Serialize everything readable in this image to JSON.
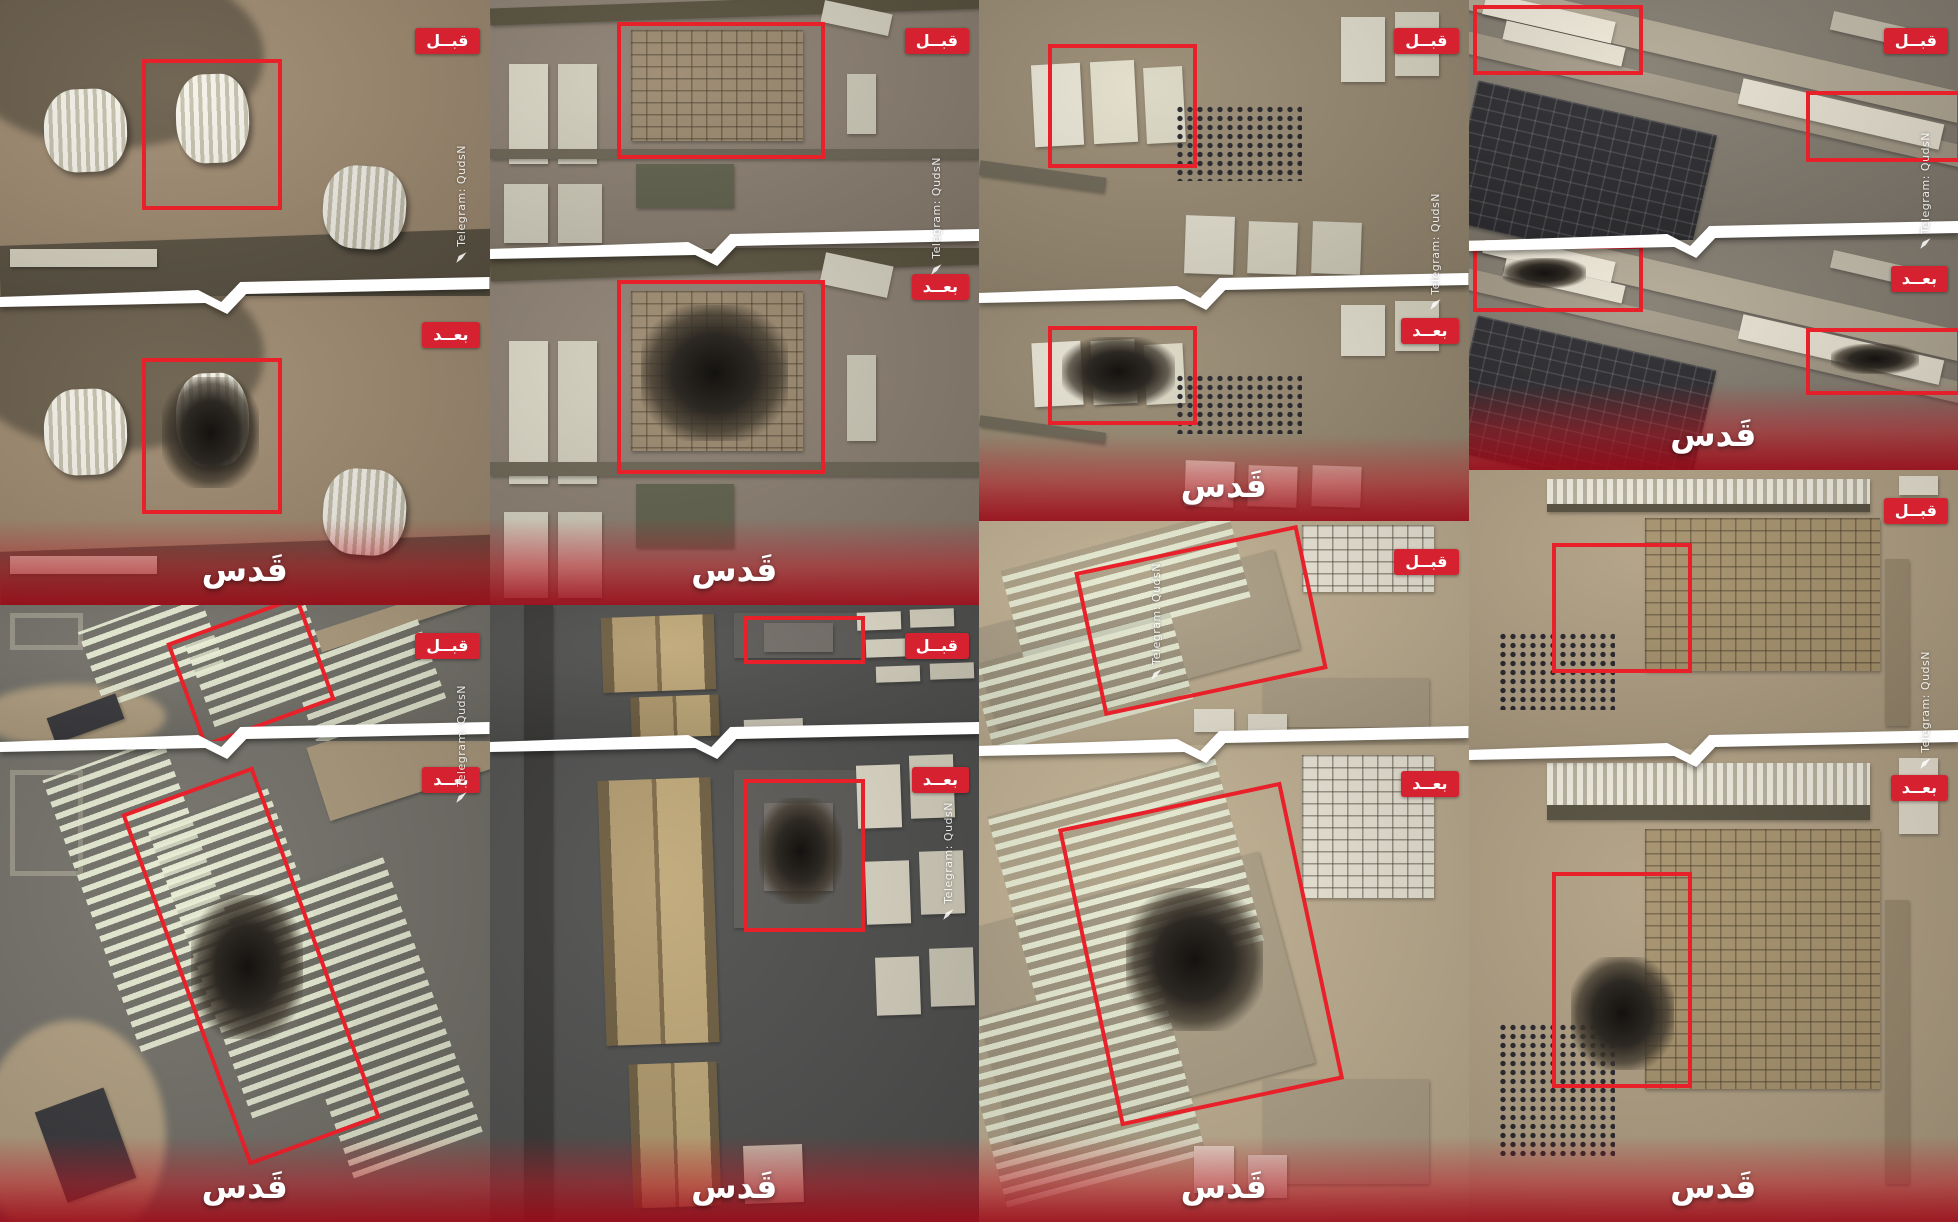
{
  "labels": {
    "before": "قبــل",
    "after": "بعــد",
    "quds_watermark": "قَدس",
    "telegram": "Telegram: QudsN"
  },
  "colors": {
    "badge_red": "#d62230",
    "target_box_red": "#e8202a",
    "separator_white": "#ffffff",
    "after_fade_red": "#b41824",
    "watermark_white": "#ffffff"
  },
  "grid": {
    "columns": 4,
    "rows": 2,
    "width_px": 1958,
    "height_px": 1222
  },
  "pairs": [
    {
      "name": "hangars-site",
      "col": 0,
      "top": 0,
      "height": 49.5,
      "split": 49,
      "scene": {
        "base": "#a08c72",
        "shapes": [
          {
            "x": -10,
            "y": -20,
            "w": 40,
            "h": 45,
            "c": "#44474a",
            "k": "blob"
          },
          {
            "x": -8,
            "y": -12,
            "w": 62,
            "h": 62,
            "c": "#6b5f4c",
            "k": "blob"
          },
          {
            "x": 0,
            "y": 80,
            "w": 104,
            "h": 24,
            "c": "#5d5545",
            "r": -2
          },
          {
            "x": 2,
            "y": 84,
            "w": 30,
            "h": 6,
            "c": "#ddd8c6"
          },
          {
            "x": 9,
            "y": 30,
            "w": 17,
            "h": 28,
            "k": "hangar",
            "r": -2
          },
          {
            "x": 36,
            "y": 25,
            "w": 15,
            "h": 30,
            "k": "hangar",
            "r": -2
          },
          {
            "x": 66,
            "y": 56,
            "w": 17,
            "h": 28,
            "k": "hangar",
            "r": 4
          }
        ]
      },
      "boxes": [
        {
          "x": 29,
          "y": 20,
          "w": 27,
          "h": 48
        }
      ],
      "damage": [
        {
          "x": 33,
          "y": 26,
          "w": 20,
          "h": 36
        }
      ],
      "telegram": {
        "x": 93,
        "y": 24
      }
    },
    {
      "name": "barracks-compound",
      "col": 1,
      "top": 0,
      "height": 49.5,
      "split": 41,
      "scene": {
        "base": "#8d8173",
        "shapes": [
          {
            "x": 0,
            "y": 0,
            "w": 100,
            "h": 7,
            "c": "#59523f",
            "r": -2
          },
          {
            "x": 4,
            "y": 26,
            "w": 8,
            "h": 40,
            "c": "#dcd8c7"
          },
          {
            "x": 14,
            "y": 26,
            "w": 8,
            "h": 40,
            "c": "#d4d0bf"
          },
          {
            "x": 3,
            "y": 74,
            "w": 9,
            "h": 24,
            "c": "#d9d5c4"
          },
          {
            "x": 14,
            "y": 74,
            "w": 9,
            "h": 24,
            "c": "#d1cdbc"
          },
          {
            "x": 29,
            "y": 12,
            "w": 35,
            "h": 45,
            "c": "#9c8a70",
            "k": "blocks"
          },
          {
            "x": 68,
            "y": 3,
            "w": 14,
            "h": 9,
            "c": "#d6d2c2",
            "r": 12
          },
          {
            "x": 73,
            "y": 30,
            "w": 6,
            "h": 24,
            "c": "#cfcbba"
          },
          {
            "x": 30,
            "y": 66,
            "w": 20,
            "h": 18,
            "c": "#63634f"
          },
          {
            "x": 0,
            "y": 60,
            "w": 100,
            "h": 4,
            "c": "#6e6757"
          }
        ]
      },
      "boxes": [
        {
          "x": 26,
          "y": 9,
          "w": 41,
          "h": 52
        }
      ],
      "damage": [
        {
          "x": 31,
          "y": 16,
          "w": 30,
          "h": 38
        }
      ],
      "telegram": {
        "x": 90,
        "y": 26
      }
    },
    {
      "name": "warehouse-tanks-site",
      "col": 2,
      "top": 0,
      "height": 42.6,
      "split": 56,
      "scene": {
        "base": "#998b73",
        "shapes": [
          {
            "x": 11,
            "y": 22,
            "w": 10,
            "h": 28,
            "c": "#e8e4d4",
            "r": -3
          },
          {
            "x": 23,
            "y": 21,
            "w": 9,
            "h": 28,
            "c": "#e2deca",
            "r": -3
          },
          {
            "x": 34,
            "y": 23,
            "w": 8,
            "h": 26,
            "c": "#dbd7c4",
            "r": -3
          },
          {
            "x": 40,
            "y": 36,
            "w": 26,
            "h": 26,
            "k": "dots"
          },
          {
            "x": 74,
            "y": 6,
            "w": 9,
            "h": 22,
            "c": "#e4e0d0"
          },
          {
            "x": 85,
            "y": 4,
            "w": 9,
            "h": 22,
            "c": "#ddd9c6"
          },
          {
            "x": 42,
            "y": 74,
            "w": 10,
            "h": 20,
            "c": "#e6e2d2",
            "r": 2
          },
          {
            "x": 55,
            "y": 76,
            "w": 10,
            "h": 18,
            "c": "#dfdbc9",
            "r": 2
          },
          {
            "x": 68,
            "y": 76,
            "w": 10,
            "h": 18,
            "c": "#d8d4c2",
            "r": 2
          },
          {
            "x": 0,
            "y": 58,
            "w": 26,
            "h": 5,
            "c": "#6e6757",
            "r": 8
          }
        ]
      },
      "boxes": [
        {
          "x": 14,
          "y": 15,
          "w": 29,
          "h": 40
        }
      ],
      "damage": [
        {
          "x": 17,
          "y": 20,
          "w": 23,
          "h": 30
        }
      ],
      "telegram": {
        "x": 92,
        "y": 37
      }
    },
    {
      "name": "airbase-complex",
      "col": 3,
      "top": 0,
      "height": 38.5,
      "split": 51,
      "scene": {
        "base": "#847d71",
        "shapes": [
          {
            "x": -5,
            "y": 16,
            "w": 115,
            "h": 13,
            "c": "#b3a995",
            "r": 13
          },
          {
            "x": -5,
            "y": 38,
            "w": 115,
            "h": 9,
            "c": "#a49a88",
            "r": 13
          },
          {
            "x": -2,
            "y": 44,
            "w": 50,
            "h": 60,
            "k": "blocks-dark",
            "r": 13
          },
          {
            "x": 3,
            "y": 3,
            "w": 27,
            "h": 9,
            "c": "#efe9d9",
            "r": 13
          },
          {
            "x": 7,
            "y": 14,
            "w": 25,
            "h": 8,
            "c": "#e6e0d0",
            "r": 13
          },
          {
            "x": 55,
            "y": 42,
            "w": 42,
            "h": 11,
            "c": "#e9e3d3",
            "r": 13
          },
          {
            "x": 74,
            "y": 8,
            "w": 15,
            "h": 8,
            "c": "#c6bfae",
            "r": 13
          }
        ]
      },
      "boxes": [
        {
          "x": 1,
          "y": 2,
          "w": 33,
          "h": 26
        },
        {
          "x": 69,
          "y": 38,
          "w": 30,
          "h": 26
        }
      ],
      "damage": [
        {
          "x": 7,
          "y": 8,
          "w": 17,
          "h": 13
        },
        {
          "x": 74,
          "y": 45,
          "w": 18,
          "h": 13
        }
      ],
      "telegram": {
        "x": 92,
        "y": 28
      }
    },
    {
      "name": "camp-rows",
      "col": 0,
      "top": 49.5,
      "height": 50.5,
      "split": 22,
      "scene": {
        "base": "#74726a",
        "shapes": [
          {
            "x": -4,
            "y": 58,
            "w": 38,
            "h": 48,
            "c": "#b3a183",
            "k": "blob"
          },
          {
            "x": 64,
            "y": -6,
            "w": 45,
            "h": 16,
            "c": "#ab9a7d",
            "r": -18
          },
          {
            "x": 2,
            "y": 6,
            "w": 13,
            "h": 20,
            "k": "ring"
          },
          {
            "x": 18,
            "y": 2,
            "w": 26,
            "h": 60,
            "k": "rows",
            "r": -20
          },
          {
            "x": 40,
            "y": 12,
            "w": 26,
            "h": 64,
            "k": "rows",
            "r": -20
          },
          {
            "x": 61,
            "y": 26,
            "w": 28,
            "h": 62,
            "k": "rows",
            "r": -20
          },
          {
            "x": 10,
            "y": 74,
            "w": 15,
            "h": 20,
            "c": "#3a3a3e",
            "r": -20
          }
        ]
      },
      "boxes": [
        {
          "x": 37,
          "y": 8,
          "w": 27,
          "h": 76,
          "r": -20
        }
      ],
      "damage": [
        {
          "x": 39,
          "y": 32,
          "w": 23,
          "h": 30
        }
      ],
      "telegram": {
        "x": 93,
        "y": 13
      }
    },
    {
      "name": "warehouse-compound",
      "col": 1,
      "top": 49.5,
      "height": 50.5,
      "split": 22,
      "scene": {
        "base": "#515150",
        "shapes": [
          {
            "x": 7,
            "y": 0,
            "w": 6,
            "h": 100,
            "c": "#3b3a38"
          },
          {
            "x": 50,
            "y": 6,
            "w": 26,
            "h": 33,
            "c": "#5d5c59"
          },
          {
            "x": 23,
            "y": 8,
            "w": 23,
            "h": 55,
            "k": "gable",
            "r": -2
          },
          {
            "x": 29,
            "y": 67,
            "w": 18,
            "h": 30,
            "k": "gable",
            "r": -2
          },
          {
            "x": 56,
            "y": 13,
            "w": 13,
            "h": 17,
            "c": "#76706a",
            "k": "ring2"
          },
          {
            "x": 75,
            "y": 5,
            "w": 9,
            "h": 13,
            "c": "#e4dfcd",
            "r": -2
          },
          {
            "x": 86,
            "y": 3,
            "w": 9,
            "h": 13,
            "c": "#dcd7c4",
            "r": -2
          },
          {
            "x": 77,
            "y": 25,
            "w": 9,
            "h": 13,
            "c": "#dfdac8",
            "r": -2
          },
          {
            "x": 88,
            "y": 23,
            "w": 9,
            "h": 13,
            "c": "#d7d2c0",
            "r": -2
          },
          {
            "x": 79,
            "y": 45,
            "w": 9,
            "h": 12,
            "c": "#dad5c3",
            "r": -2
          },
          {
            "x": 90,
            "y": 43,
            "w": 9,
            "h": 12,
            "c": "#d2cdbb",
            "r": -2
          },
          {
            "x": 52,
            "y": 84,
            "w": 12,
            "h": 12,
            "c": "#cfcaba",
            "r": -2
          }
        ]
      },
      "boxes": [
        {
          "x": 52,
          "y": 8,
          "w": 23,
          "h": 30
        }
      ],
      "damage": [
        {
          "x": 55,
          "y": 12,
          "w": 17,
          "h": 22
        }
      ],
      "telegram": {
        "x": 92.5,
        "y": 32
      }
    },
    {
      "name": "tent-rows-site",
      "col": 2,
      "top": 42.6,
      "height": 57.4,
      "split": 32,
      "scene": {
        "base": "#c0b092",
        "shapes": [
          {
            "x": 0,
            "y": 30,
            "w": 64,
            "h": 46,
            "c": "#ac9f86",
            "r": -15
          },
          {
            "x": 6,
            "y": 8,
            "w": 48,
            "h": 40,
            "k": "rows",
            "r": -15
          },
          {
            "x": 0,
            "y": 52,
            "w": 42,
            "h": 40,
            "k": "rows",
            "r": -15
          },
          {
            "x": 66,
            "y": 2,
            "w": 27,
            "h": 30,
            "c": "#ece7d8",
            "k": "blocks"
          },
          {
            "x": 58,
            "y": 70,
            "w": 34,
            "h": 22,
            "c": "#b0a289"
          },
          {
            "x": 44,
            "y": 84,
            "w": 8,
            "h": 10,
            "c": "#eee9d9"
          },
          {
            "x": 55,
            "y": 86,
            "w": 8,
            "h": 9,
            "c": "#e7e2d2"
          }
        ]
      },
      "boxes": [
        {
          "x": 22,
          "y": 12,
          "w": 45,
          "h": 62,
          "r": -12
        }
      ],
      "damage": [
        {
          "x": 30,
          "y": 30,
          "w": 28,
          "h": 30
        }
      ],
      "telegram": {
        "x": 35,
        "y": 6
      }
    },
    {
      "name": "storage-yard",
      "col": 3,
      "top": 38.5,
      "height": 61.5,
      "split": 37,
      "scene": {
        "base": "#b1a084",
        "shapes": [
          {
            "x": 16,
            "y": 3,
            "w": 66,
            "h": 9,
            "k": "rows-h"
          },
          {
            "x": 16,
            "y": 12,
            "w": 66,
            "h": 3,
            "c": "#55503f"
          },
          {
            "x": 36,
            "y": 17,
            "w": 48,
            "h": 55,
            "c": "#a7926c",
            "k": "blocks"
          },
          {
            "x": 88,
            "y": 2,
            "w": 8,
            "h": 7,
            "c": "#e9e3d2"
          },
          {
            "x": 88,
            "y": 11,
            "w": 8,
            "h": 7,
            "c": "#e2dccb"
          },
          {
            "x": 85,
            "y": 32,
            "w": 5,
            "h": 60,
            "c": "#9a8a6e"
          },
          {
            "x": 6,
            "y": 58,
            "w": 24,
            "h": 28,
            "k": "dots"
          }
        ]
      },
      "boxes": [
        {
          "x": 17,
          "y": 26,
          "w": 27,
          "h": 44
        }
      ],
      "damage": [
        {
          "x": 21,
          "y": 44,
          "w": 21,
          "h": 24
        }
      ],
      "telegram": {
        "x": 92,
        "y": 24
      }
    }
  ]
}
